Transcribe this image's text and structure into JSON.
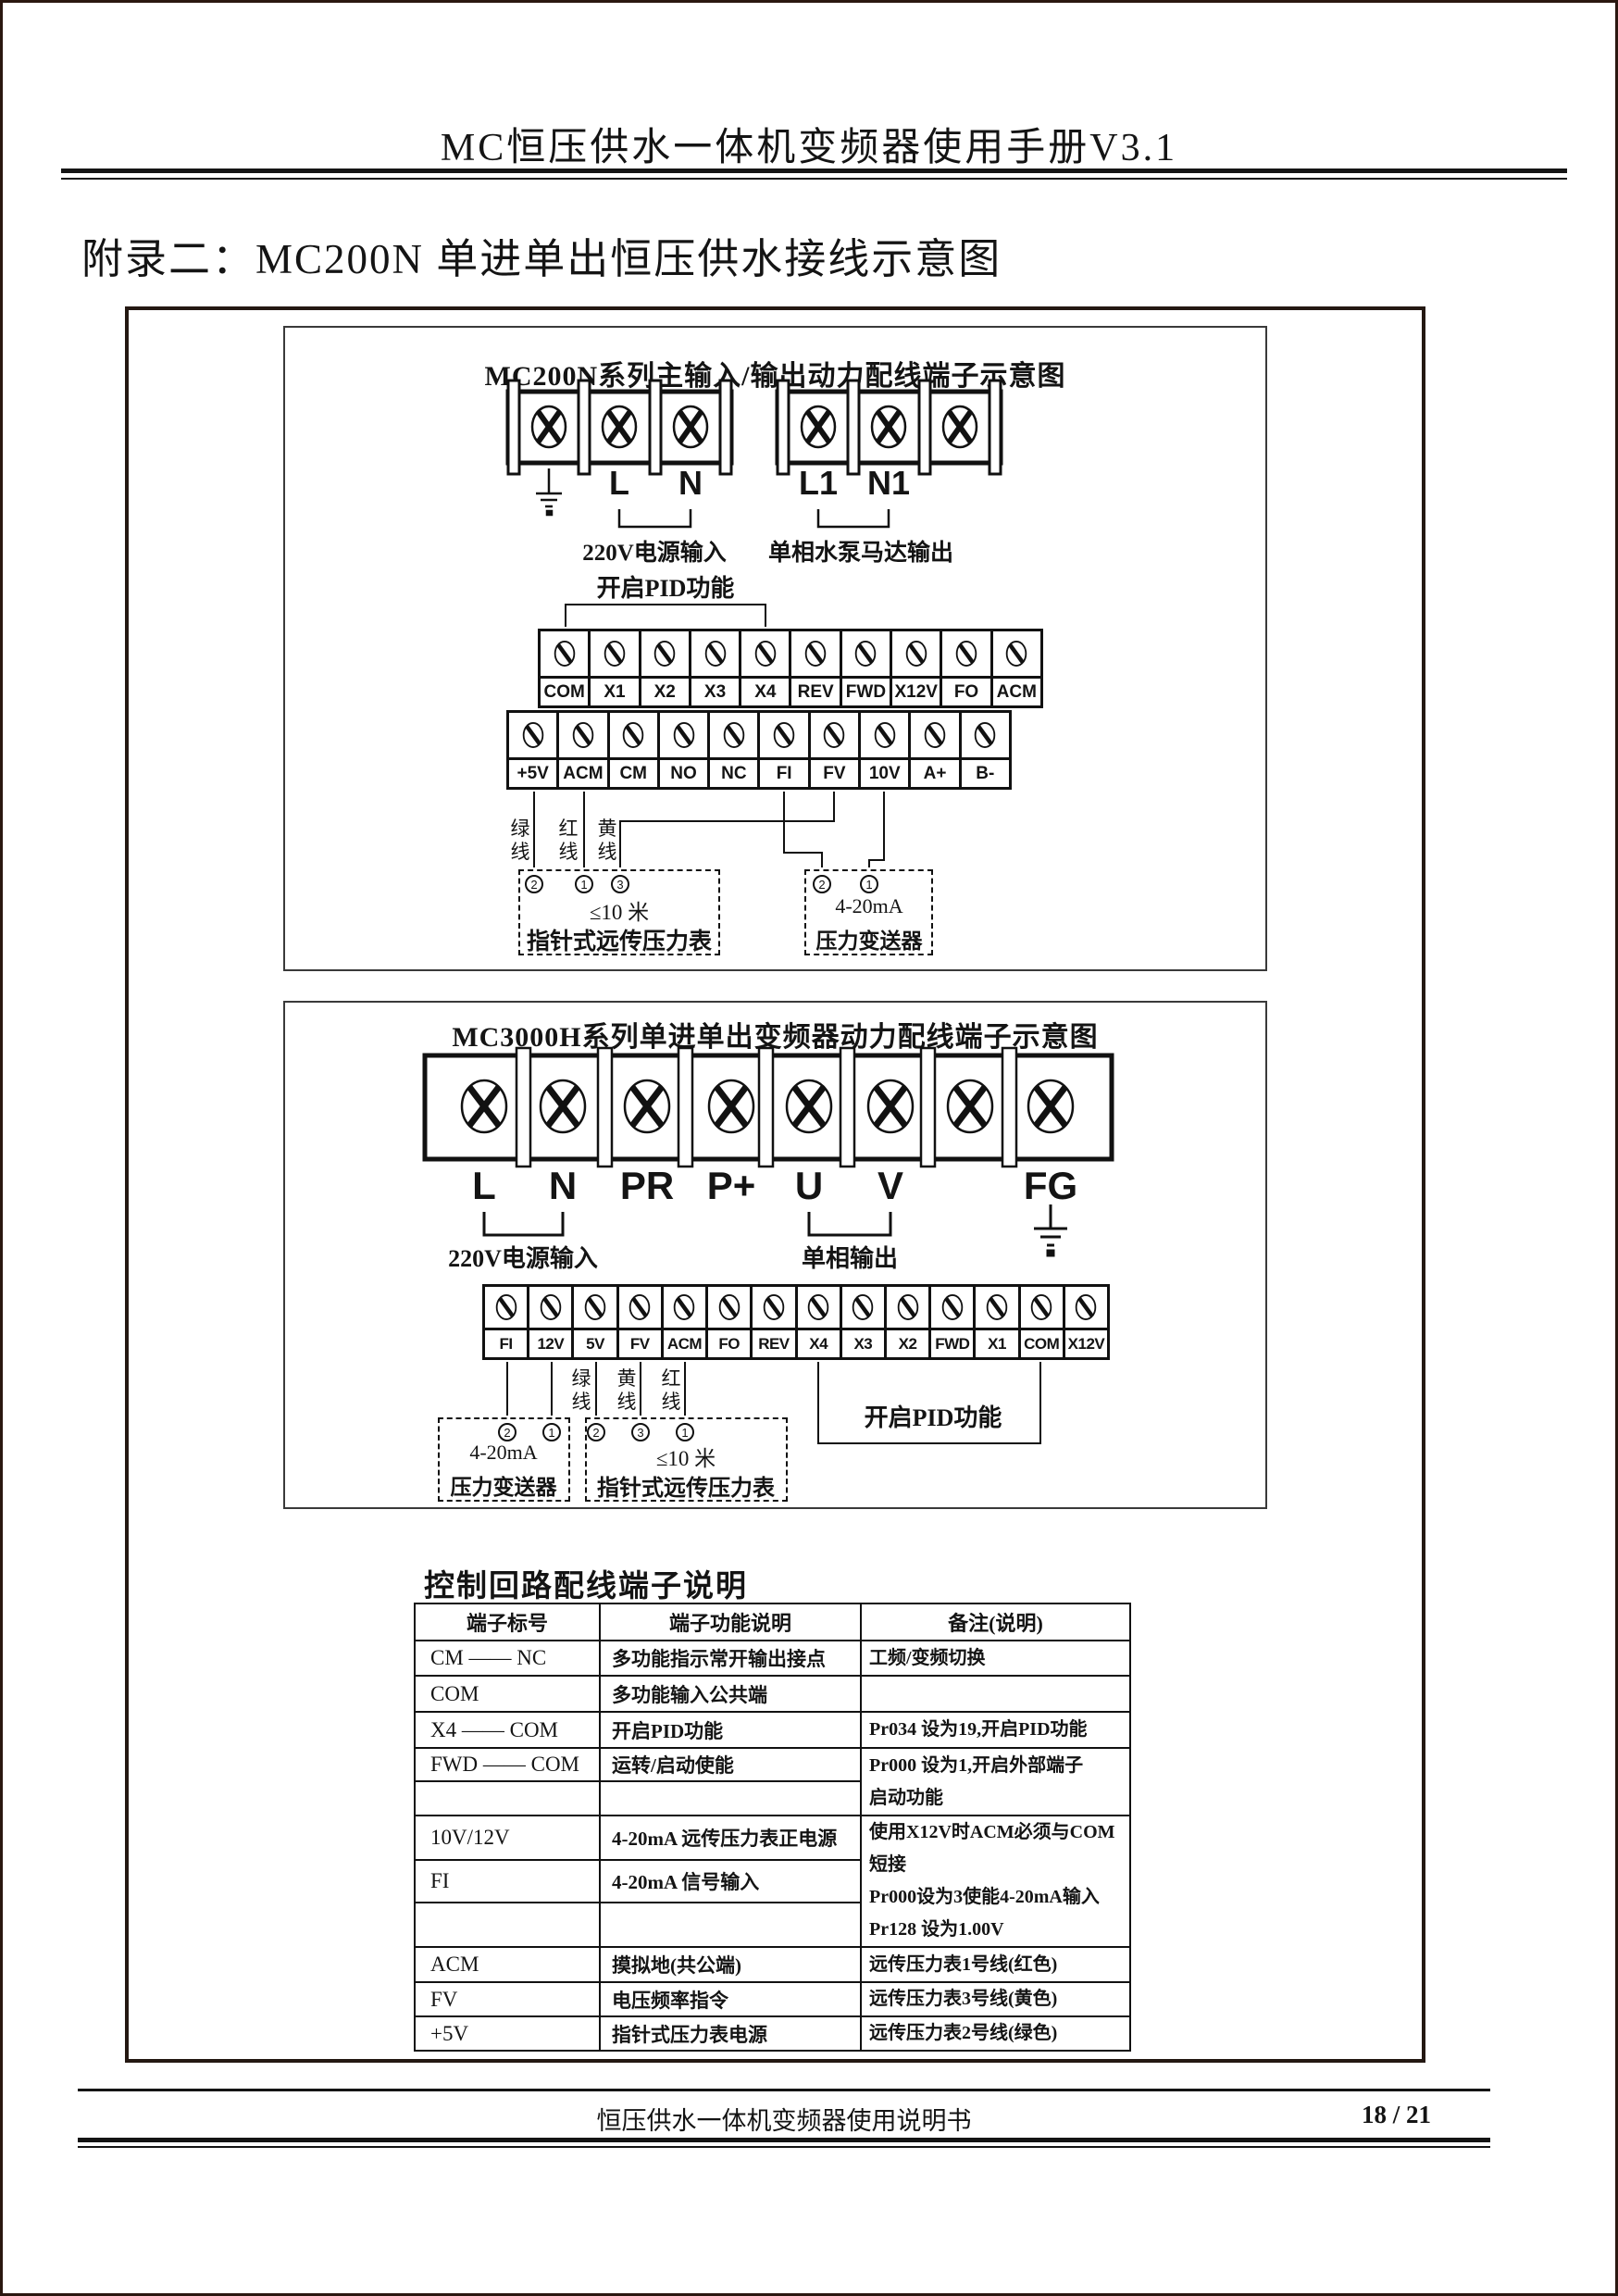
{
  "page": {
    "header_title": "MC恒压供水一体机变频器使用手册V3.1",
    "appendix_title": "附录二：MC200N 单进单出恒压供水接线示意图",
    "footer_text": "恒压供水一体机变频器使用说明书",
    "page_number": "18 / 21"
  },
  "diagram1": {
    "title": "MC200N系列主输入/输出动力配线端子示意图",
    "input_labels": [
      "L",
      "N"
    ],
    "output_labels": [
      "L1",
      "N1"
    ],
    "input_caption": "220V电源输入",
    "output_caption": "单相水泵马达输出",
    "pid_caption": "开启PID功能",
    "row1": [
      "COM",
      "X1",
      "X2",
      "X3",
      "X4",
      "REV",
      "FWD",
      "X12V",
      "FO",
      "ACM"
    ],
    "row2": [
      "+5V",
      "ACM",
      "CM",
      "NO",
      "NC",
      "FI",
      "FV",
      "10V",
      "A+",
      "B-"
    ],
    "wire_green": "绿线",
    "wire_red": "红线",
    "wire_yellow": "黄线",
    "gauge_numbers": [
      "2",
      "1",
      "3"
    ],
    "gauge_line1": "≤10 米",
    "gauge_line2": "指针式远传压力表",
    "sensor_numbers": [
      "2",
      "1"
    ],
    "sensor_line1": "4-20mA",
    "sensor_line2": "压力变送器"
  },
  "diagram2": {
    "title": "MC3000H系列单进单出变频器动力配线端子示意图",
    "power_labels": [
      "L",
      "N",
      "PR",
      "P+",
      "U",
      "V",
      "",
      "FG"
    ],
    "input_caption": "220V电源输入",
    "output_caption": "单相输出",
    "pid_caption": "开启PID功能",
    "row": [
      "FI",
      "12V",
      "5V",
      "FV",
      "ACM",
      "FO",
      "REV",
      "X4",
      "X3",
      "X2",
      "FWD",
      "X1",
      "COM",
      "X12V"
    ],
    "wire_green": "绿线",
    "wire_yellow": "黄线",
    "wire_red": "红线",
    "sensor_numbers": [
      "2",
      "1"
    ],
    "sensor_line1": "4-20mA",
    "sensor_line2": "压力变送器",
    "gauge_numbers": [
      "2",
      "3",
      "1"
    ],
    "gauge_line1": "≤10 米",
    "gauge_line2": "指针式远传压力表"
  },
  "table": {
    "title": "控制回路配线端子说明",
    "headers": [
      "端子标号",
      "端子功能说明",
      "备注(说明)"
    ],
    "rows": [
      {
        "c1": "CM —— NC",
        "c2": "多功能指示常开输出接点",
        "c3": [
          "工频/变频切换"
        ],
        "c3span": 1
      },
      {
        "c1": "COM",
        "c2": "多功能输入公共端",
        "c3": [
          ""
        ],
        "c3span": 1
      },
      {
        "c1": "X4 —— COM",
        "c2": "开启PID功能",
        "c3": [
          "Pr034 设为19,开启PID功能"
        ],
        "c3span": 1
      },
      {
        "c1": "FWD —— COM",
        "c2": "运转/启动使能",
        "c3": [
          "Pr000 设为1,开启外部端子",
          "启动功能"
        ],
        "c3span": 2
      },
      {
        "c1": "",
        "c2": "",
        "c3": null
      },
      {
        "c1": "10V/12V",
        "c2": "4-20mA 远传压力表正电源",
        "c3": [
          "使用X12V时ACM必须与COM短接",
          "Pr000设为3使能4-20mA输入",
          "Pr128 设为1.00V"
        ],
        "c3span": 3
      },
      {
        "c1": "FI",
        "c2": "4-20mA 信号输入",
        "c3": null
      },
      {
        "c1": "",
        "c2": "",
        "c3": null
      },
      {
        "c1": "ACM",
        "c2": "摸拟地(共公端)",
        "c3": [
          "远传压力表1号线(红色)"
        ],
        "c3span": 1
      },
      {
        "c1": "FV",
        "c2": "电压频率指令",
        "c3": [
          "远传压力表3号线(黄色)"
        ],
        "c3span": 1
      },
      {
        "c1": "+5V",
        "c2": "指针式压力表电源",
        "c3": [
          "远传压力表2号线(绿色)"
        ],
        "c3span": 1
      }
    ]
  }
}
